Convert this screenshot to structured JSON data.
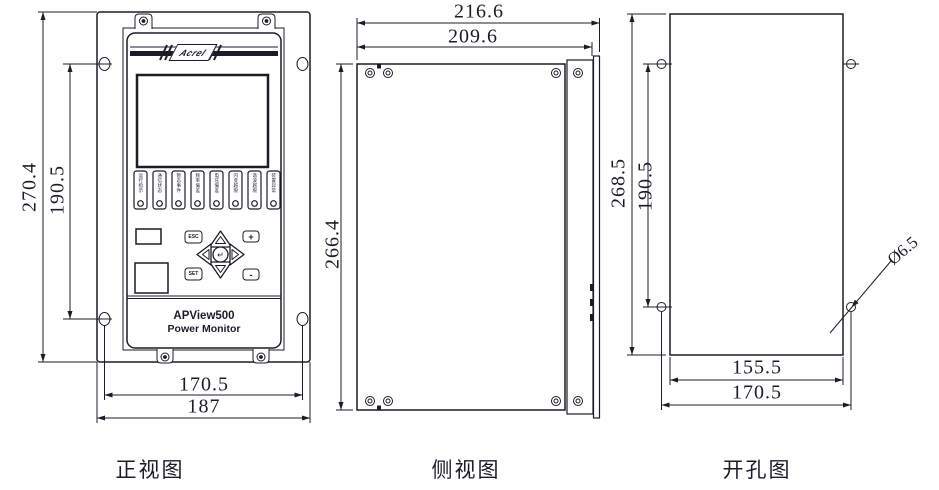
{
  "front_view": {
    "caption": "正视图",
    "dim_overall_height": "270.4",
    "dim_hole_pitch_v": "190.5",
    "dim_hole_pitch_h": "170.5",
    "dim_overall_width": "187",
    "logo_text": "Acrel",
    "model": "APView500",
    "subtitle": "Power Monitor",
    "keypad": {
      "esc": "ESC",
      "set": "SET",
      "plus": "+",
      "minus": "-",
      "enter": "↵"
    },
    "led_labels": [
      "运行指示",
      "通信状态",
      "暂态事件",
      "频率偏差",
      "电压偏差",
      "闪变越限",
      "谐波越限",
      "装置异常"
    ]
  },
  "side_view": {
    "caption": "侧视图",
    "dim_overall_depth": "216.6",
    "dim_body_depth": "209.6",
    "dim_body_height": "266.4"
  },
  "cutout_view": {
    "caption": "开孔图",
    "dim_overall_height": "268.5",
    "dim_hole_pitch_v": "190.5",
    "dim_cutout_width": "155.5",
    "dim_hole_pitch_h": "170.5",
    "dim_hole_diameter": "Ø6.5"
  }
}
